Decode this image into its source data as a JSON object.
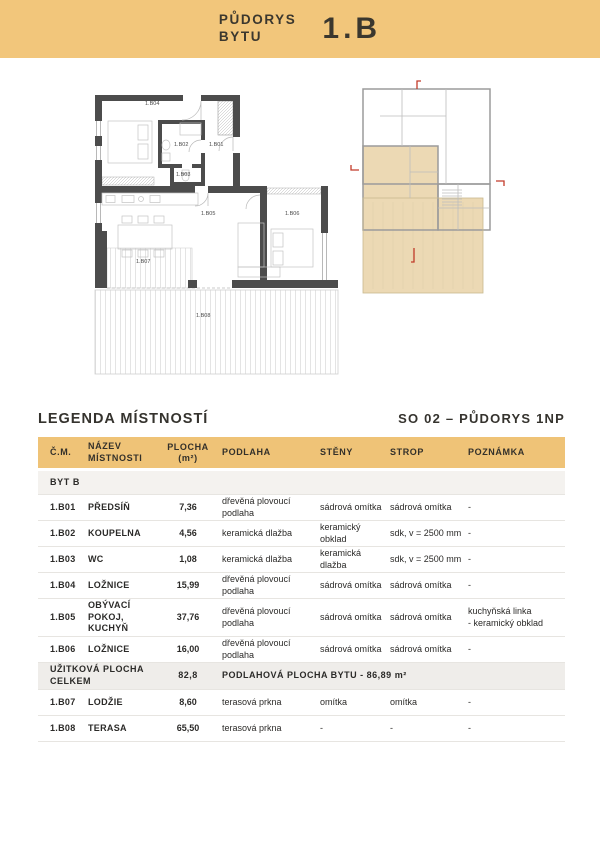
{
  "header": {
    "title": "PŮDORYS\nBYTU",
    "unit": "1.B"
  },
  "legend": {
    "title": "LEGENDA MÍSTNOSTÍ",
    "drawing_ref": "SO 02 – PŮDORYS 1NP"
  },
  "plan": {
    "labels": {
      "r01": "1.B01",
      "r02": "1.B02",
      "r03": "1.B03",
      "r04": "1.B04",
      "r05": "1.B05",
      "r06": "1.B06",
      "r07": "1.B07",
      "r08": "1.B08"
    }
  },
  "table": {
    "columns": {
      "cm": "Č.M.",
      "name": "NÁZEV MÍSTNOSTI",
      "area1": "PLOCHA",
      "area2": "(m²)",
      "floor": "PODLAHA",
      "walls": "STĚNY",
      "ceiling": "STROP",
      "note": "POZNÁMKA"
    },
    "section": "BYT B",
    "rows": [
      {
        "id": "1.B01",
        "name": "PŘEDSÍŇ",
        "area": "7,36",
        "floor": "dřevěná plovoucí podlaha",
        "walls": "sádrová omítka",
        "ceiling": "sádrová omítka",
        "note": "-"
      },
      {
        "id": "1.B02",
        "name": "KOUPELNA",
        "area": "4,56",
        "floor": "keramická dlažba",
        "walls": "keramický obklad",
        "ceiling": "sdk, v = 2500 mm",
        "note": "-"
      },
      {
        "id": "1.B03",
        "name": "WC",
        "area": "1,08",
        "floor": "keramická dlažba",
        "walls": "keramická dlažba",
        "ceiling": "sdk, v = 2500 mm",
        "note": "-"
      },
      {
        "id": "1.B04",
        "name": "LOŽNICE",
        "area": "15,99",
        "floor": "dřevěná plovoucí podlaha",
        "walls": "sádrová omítka",
        "ceiling": "sádrová omítka",
        "note": "-"
      },
      {
        "id": "1.B05",
        "name": "OBÝVACÍ POKOJ,\nKUCHYŇ",
        "area": "37,76",
        "floor": "dřevěná plovoucí podlaha",
        "walls": "sádrová omítka",
        "ceiling": "sádrová omítka",
        "note": "kuchyňská linka\n- keramický obklad"
      },
      {
        "id": "1.B06",
        "name": "LOŽNICE",
        "area": "16,00",
        "floor": "dřevěná plovoucí podlaha",
        "walls": "sádrová omítka",
        "ceiling": "sádrová omítka",
        "note": "-"
      },
      {
        "id": "1.B07",
        "name": "LODŽIE",
        "area": "8,60",
        "floor": "terasová prkna",
        "walls": "omítka",
        "ceiling": "omítka",
        "note": "-"
      },
      {
        "id": "1.B08",
        "name": "TERASA",
        "area": "65,50",
        "floor": "terasová prkna",
        "walls": "-",
        "ceiling": "-",
        "note": "-"
      }
    ],
    "summary": {
      "label": "UŽITKOVÁ PLOCHA CELKEM",
      "area": "82,8",
      "note": "PODLAHOVÁ PLOCHA BYTU - 86,89 m²"
    }
  },
  "colors": {
    "accent_band": "#f2c67b",
    "table_header": "#efc377",
    "apartment_highlight": "#ecd9b4",
    "wall_dark": "#4c4c4c",
    "section_marker_red": "#c23b2a"
  }
}
